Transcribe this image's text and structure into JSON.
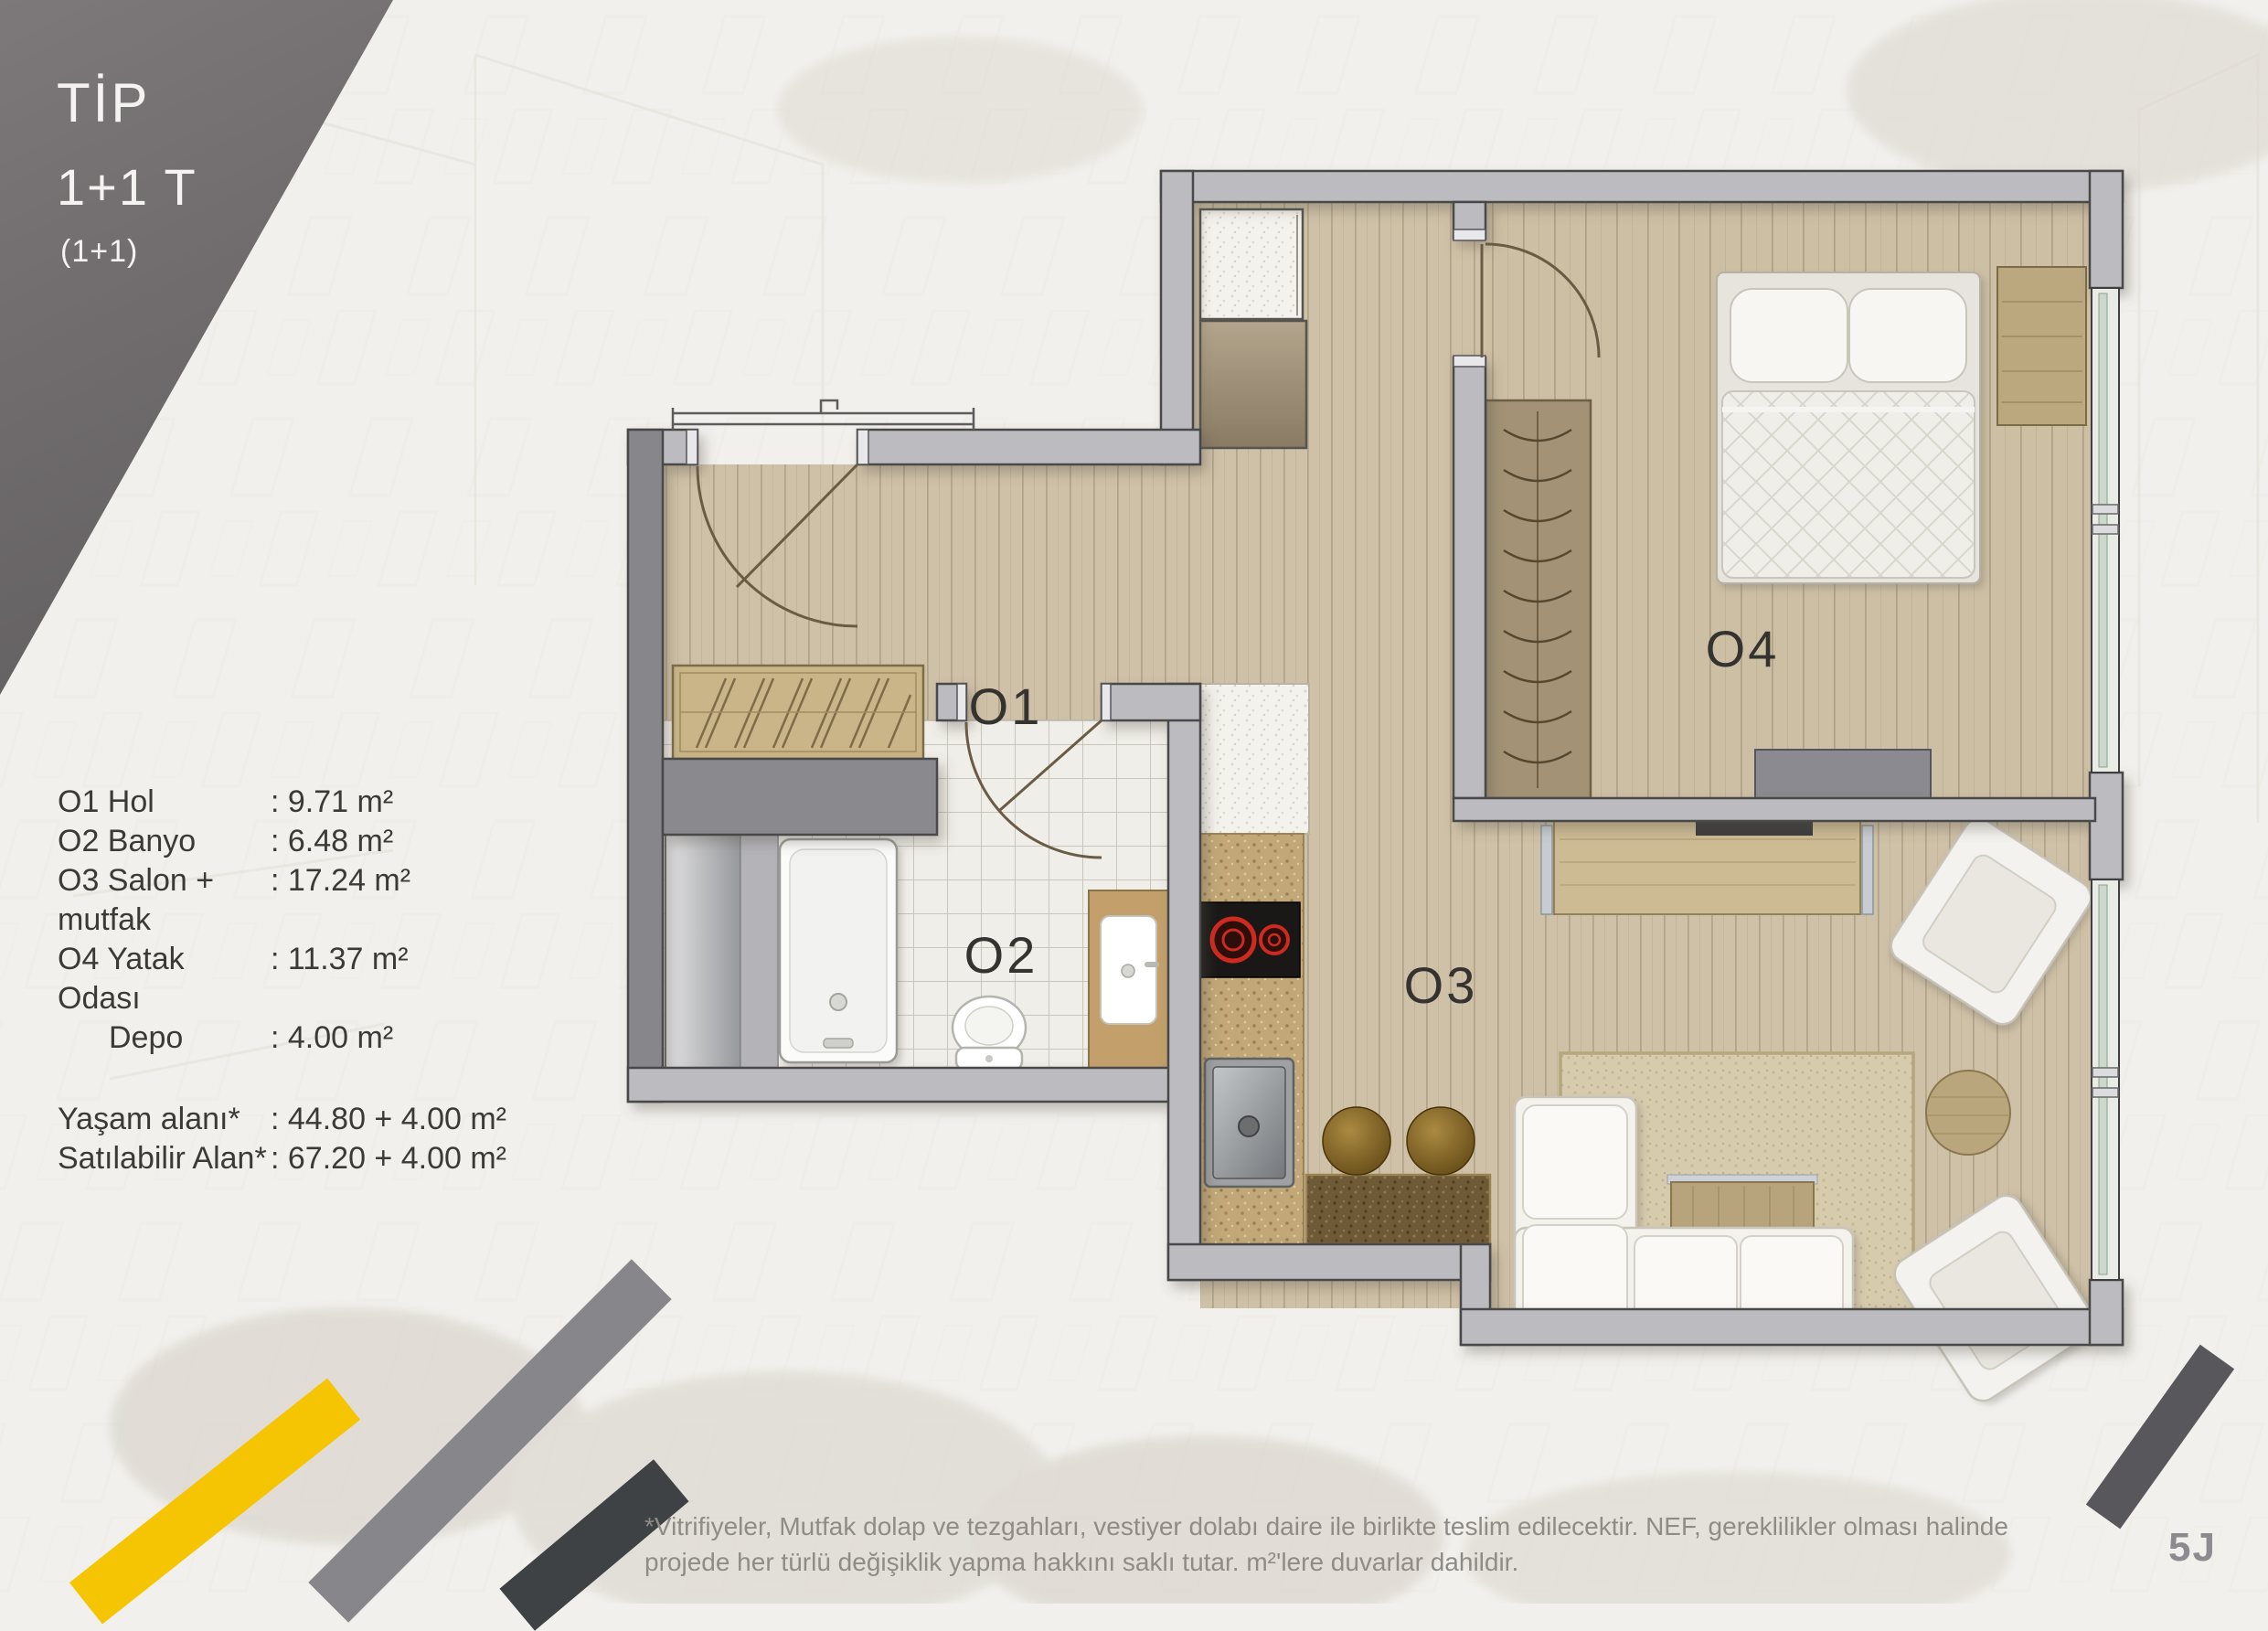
{
  "header": {
    "type_label": "TİP",
    "type_value": "1+1 T",
    "type_sub": "(1+1)"
  },
  "legend": {
    "rooms": [
      {
        "label": "O1 Hol",
        "value": ": 9.71 m²"
      },
      {
        "label": "O2 Banyo",
        "value": ": 6.48 m²"
      },
      {
        "label": "O3 Salon + mutfak",
        "value": ": 17.24 m²"
      },
      {
        "label": "O4 Yatak Odası",
        "value": ": 11.37 m²"
      },
      {
        "label": "Depo",
        "value": ": 4.00 m²"
      }
    ],
    "totals": [
      {
        "label": "Yaşam alanı*",
        "value": ": 44.80 + 4.00 m²"
      },
      {
        "label": "Satılabilir Alan*",
        "value": ": 67.20 + 4.00 m²"
      }
    ]
  },
  "plan": {
    "room_labels": [
      {
        "id": "O1",
        "text": "O1"
      },
      {
        "id": "O2",
        "text": "O2"
      },
      {
        "id": "O3",
        "text": "O3"
      },
      {
        "id": "O4",
        "text": "O4"
      }
    ],
    "colors": {
      "wall": "#bcbcc0",
      "wall_dark": "#87868b",
      "wood_floor": "#cfc1a7",
      "bath_tile": "#f0eee8",
      "counter_tan": "#c2a878",
      "burner_red": "#d2271b",
      "window_glass": "#ccd8cb"
    }
  },
  "footer": {
    "disclaimer_line1": "*Vitrifiyeler, Mutfak dolap ve tezgahları, vestiyer dolabı daire ile birlikte teslim edilecektir. NEF, gereklilikler olması halinde",
    "disclaimer_line2": "projede her türlü değişiklik yapma hakkını saklı tutar. m²'lere duvarlar dahildir.",
    "page_code": "5J"
  },
  "decor": {
    "stripe_yellow": "#f5c402",
    "stripe_gray": "#87868a",
    "stripe_dark": "#3f4245",
    "stripe_dark_br": "#58585c"
  }
}
